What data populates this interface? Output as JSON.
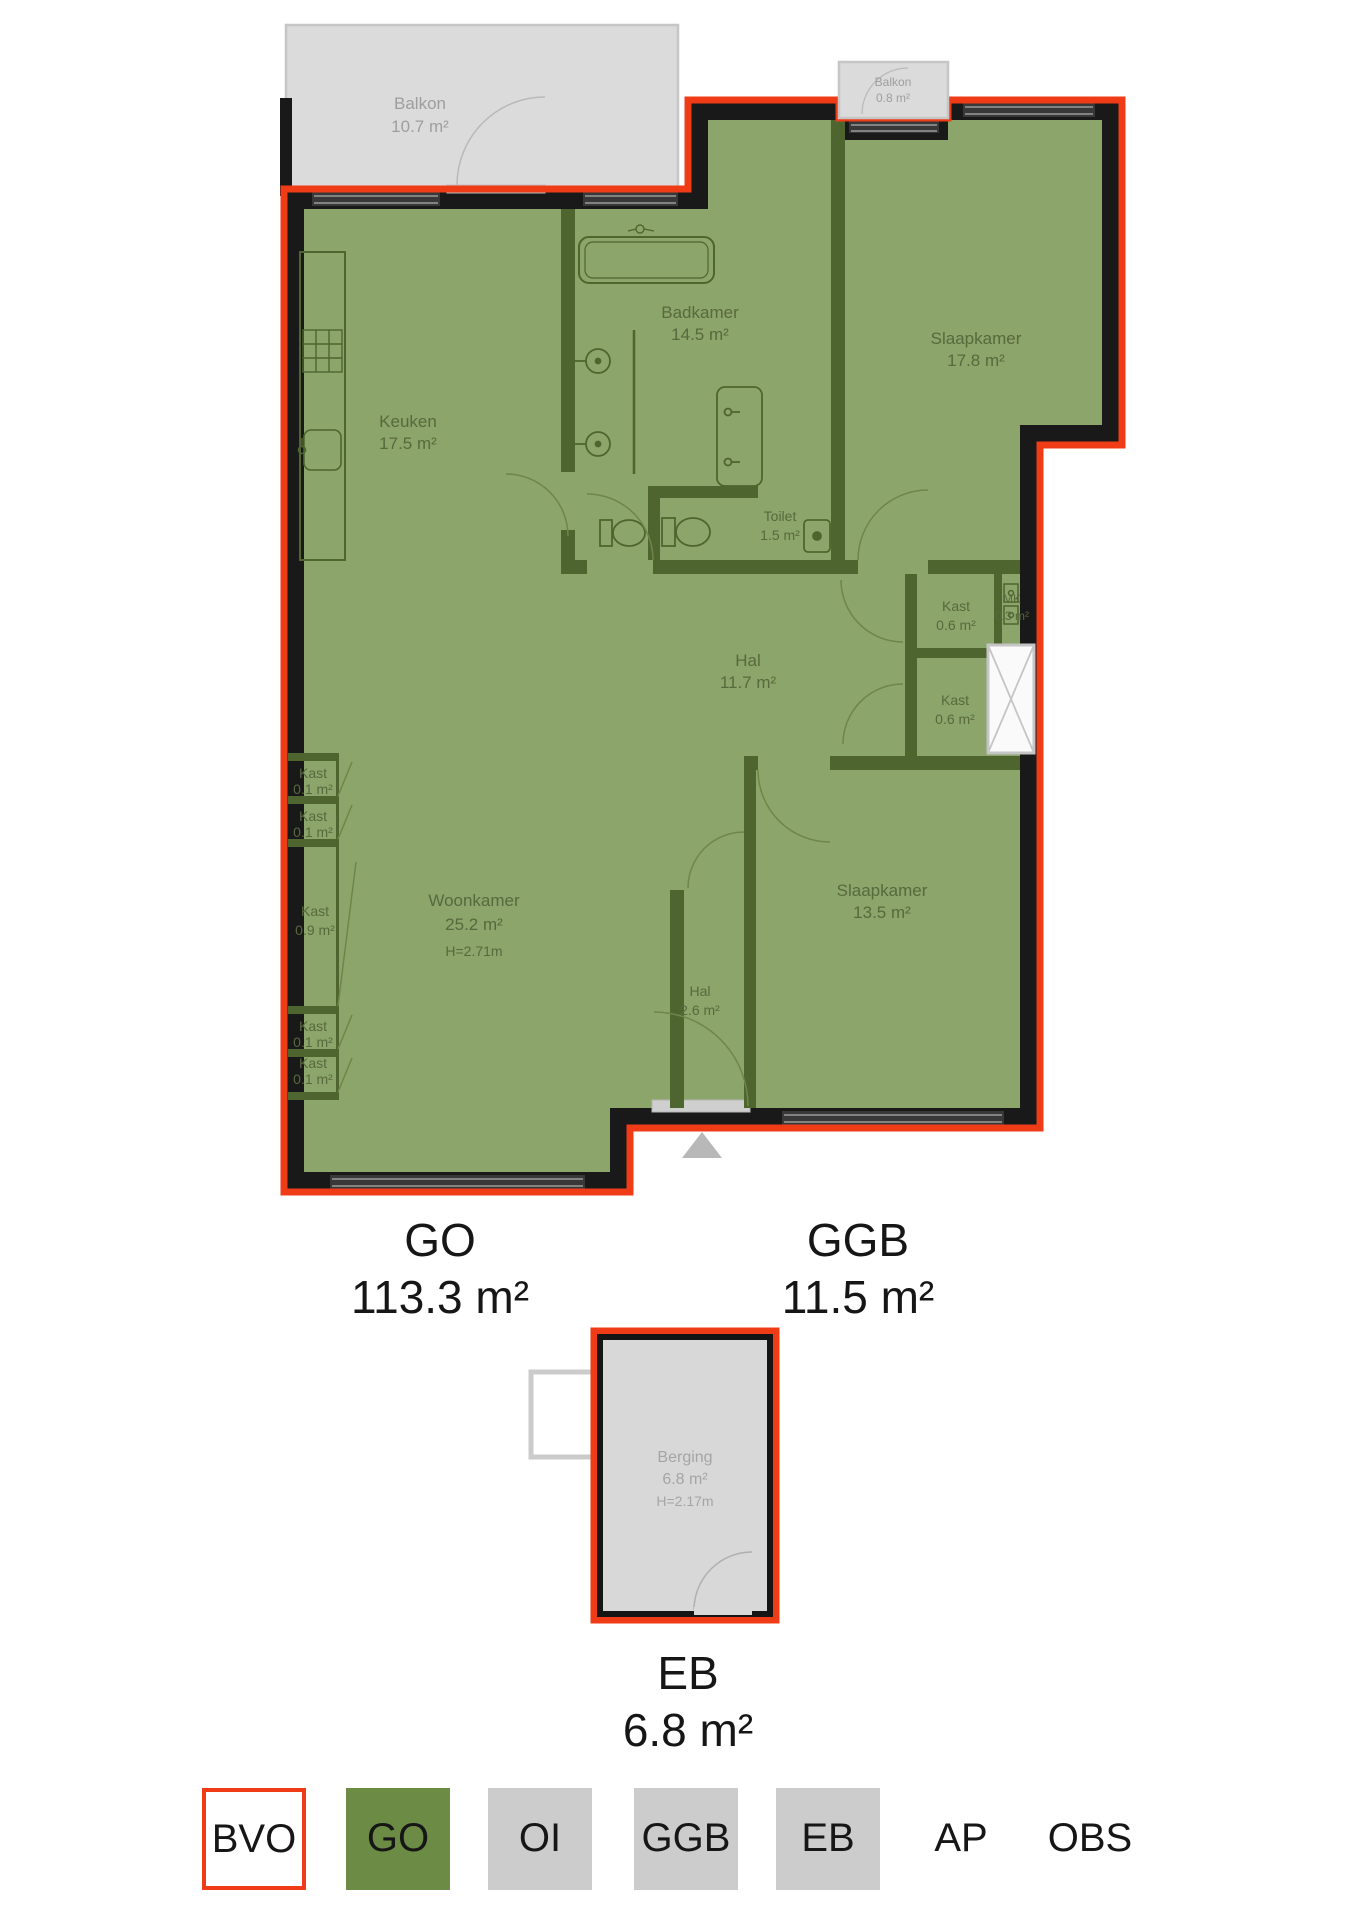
{
  "plan": {
    "balkon_tl": {
      "name": "Balkon",
      "area": "10.7 m²"
    },
    "balkon_tr": {
      "name": "Balkon",
      "area": "0.8 m²"
    },
    "keuken": {
      "name": "Keuken",
      "area": "17.5 m²"
    },
    "badkamer": {
      "name": "Badkamer",
      "area": "14.5 m²"
    },
    "slaapkamer_1": {
      "name": "Slaapkamer",
      "area": "17.8 m²"
    },
    "toilet": {
      "name": "Toilet",
      "area": "1.5 m²"
    },
    "hal_1": {
      "name": "Hal",
      "area": "11.7 m²"
    },
    "kast_1": {
      "name": "Kast",
      "area": "0.6 m²"
    },
    "mk": {
      "name": "MK",
      "area": "0.3 m²"
    },
    "kast_2": {
      "name": "Kast",
      "area": "0.6 m²"
    },
    "kast_3": {
      "name": "Kast",
      "area": "0.1 m²"
    },
    "kast_4": {
      "name": "Kast",
      "area": "0.1 m²"
    },
    "kast_5": {
      "name": "Kast",
      "area": "0.9 m²"
    },
    "kast_6": {
      "name": "Kast",
      "area": "0.1 m²"
    },
    "kast_7": {
      "name": "Kast",
      "area": "0.1 m²"
    },
    "woonkamer": {
      "name": "Woonkamer",
      "area": "25.2 m²",
      "height": "H=2.71m"
    },
    "slaapkamer_2": {
      "name": "Slaapkamer",
      "area": "13.5 m²"
    },
    "hal_2": {
      "name": "Hal",
      "area": "2.6 m²"
    },
    "berging": {
      "name": "Berging",
      "area": "6.8 m²",
      "height": "H=2.17m"
    }
  },
  "summary": {
    "go": {
      "label": "GO",
      "area": "113.3 m²"
    },
    "ggb": {
      "label": "GGB",
      "area": "11.5 m²"
    },
    "eb": {
      "label": "EB",
      "area": "6.8 m²"
    }
  },
  "legend": {
    "items": [
      {
        "label": "BVO",
        "style": "outline-red"
      },
      {
        "label": "GO",
        "style": "green"
      },
      {
        "label": "OI",
        "style": "gray"
      },
      {
        "label": "GGB",
        "style": "gray"
      },
      {
        "label": "EB",
        "style": "gray"
      },
      {
        "label": "AP",
        "style": "none"
      },
      {
        "label": "OBS",
        "style": "none"
      }
    ]
  },
  "colors": {
    "bvo_red": "#f03b17",
    "go_green_fill": "#8ca56b",
    "legend_green": "#6c8c45",
    "legend_gray": "#cccccc",
    "wall_black": "#191919",
    "interior_wall_olive": "#4e6530",
    "balkon_gray": "#dbdbdb",
    "berging_gray": "#d8d8d8"
  }
}
